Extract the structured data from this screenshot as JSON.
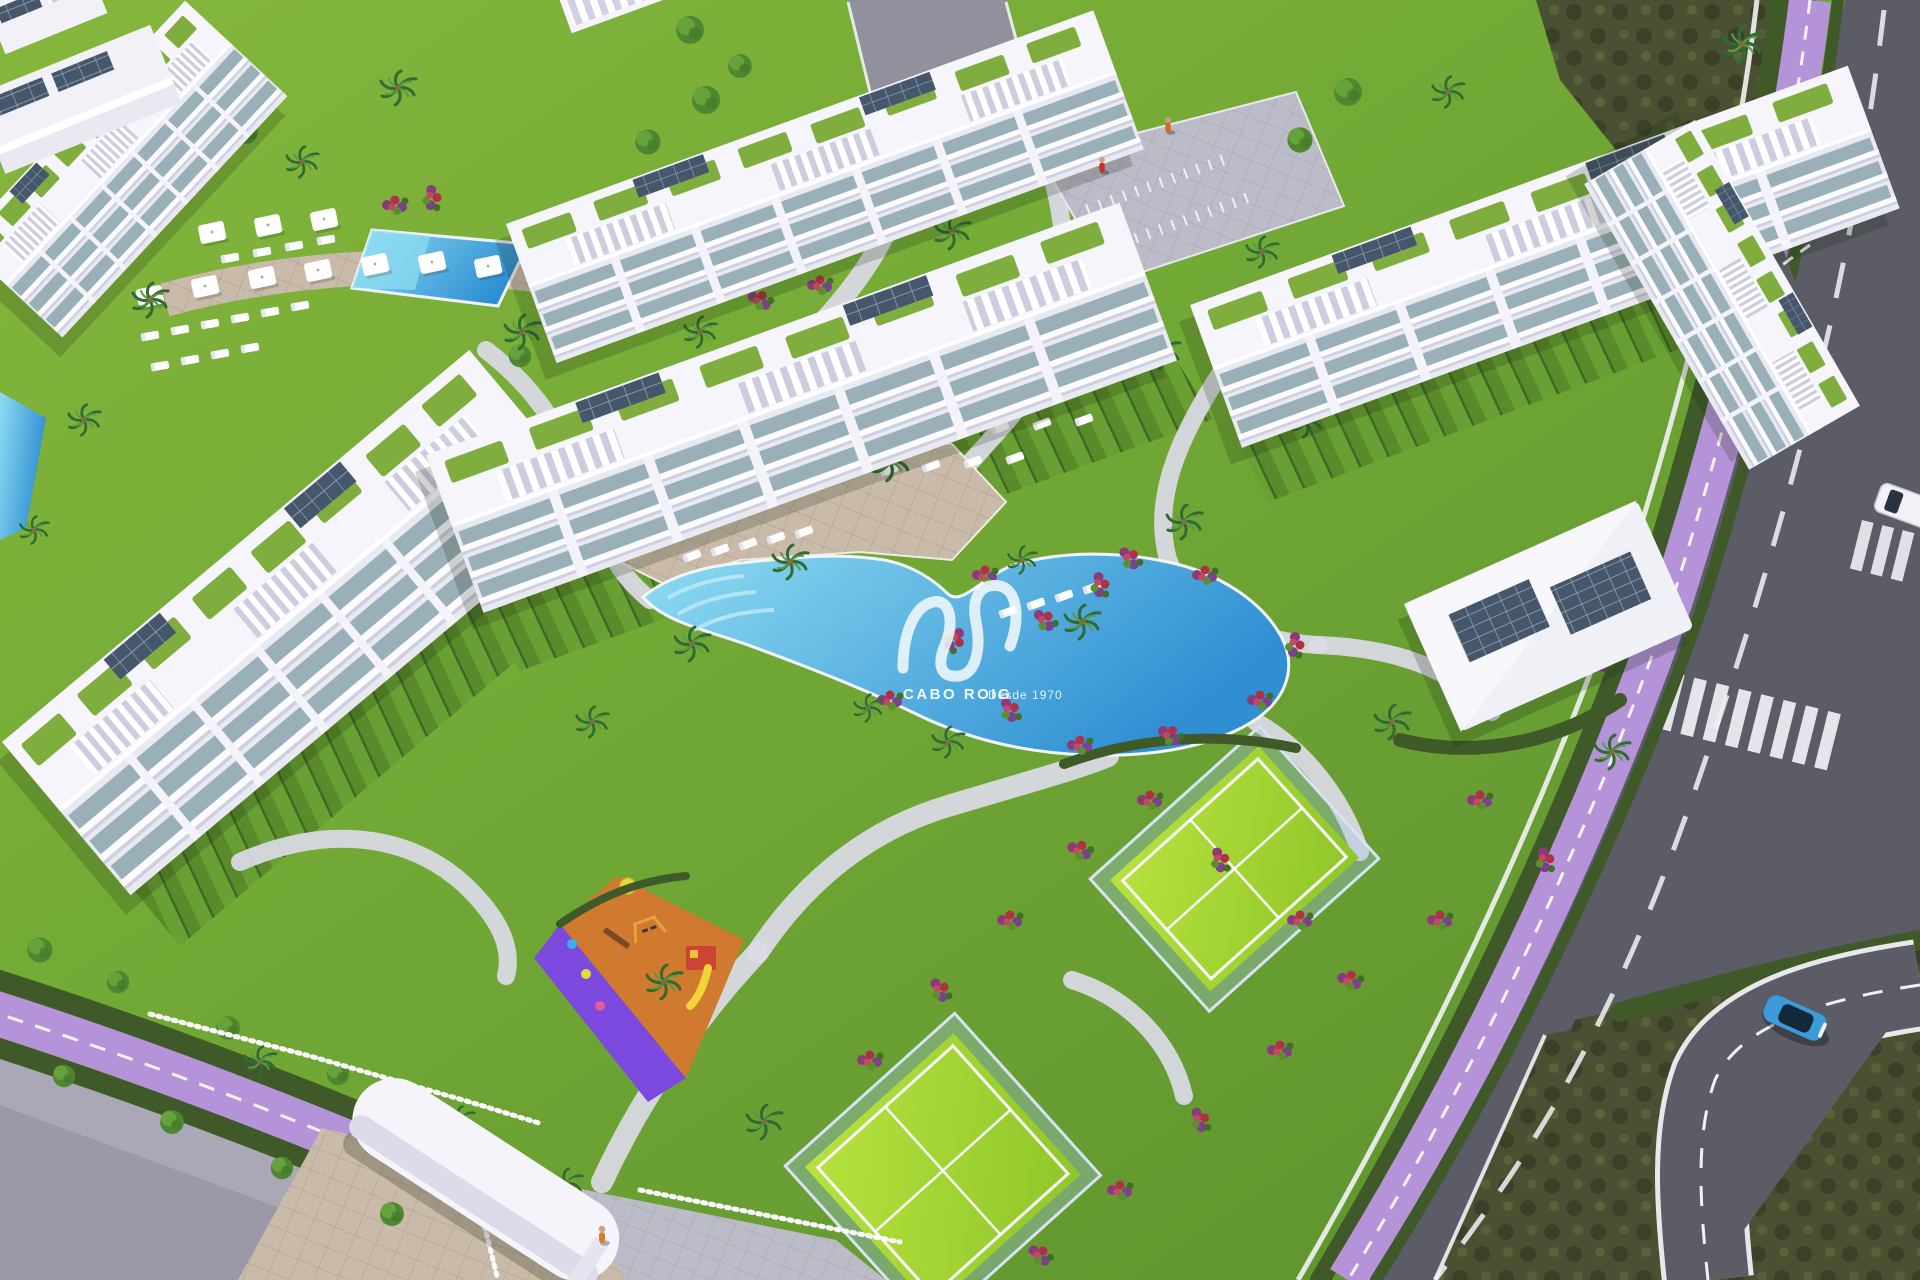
{
  "watermark": {
    "brand": "CABO ROIG",
    "tagline": "Desde 1970",
    "logo": "sis-swoosh-monogram"
  },
  "scene": {
    "type": "aerial-3d-render",
    "elements": [
      "white-apartment-buildings-with-roof-terraces",
      "central-lagoon-pool",
      "secondary-pool",
      "sun-deck-with-loungers-and-parasols",
      "padel-court-upper",
      "padel-court-lower",
      "children-playground",
      "entrance-gate-canopy",
      "perimeter-road",
      "purple-bike-lane",
      "curved-branch-road",
      "blue-car",
      "white-van",
      "scrubland",
      "palm-trees",
      "flower-beds",
      "pool-clubhouse",
      "bike-rack-plaza",
      "pedestrian-crosswalk",
      "white-picket-fence"
    ],
    "people_visible": 3,
    "vehicles_visible": 2
  },
  "palette": {
    "lawn_light": "#85b73c",
    "lawn": "#6fa634",
    "lawn_dark": "#5b8f2e",
    "scrub": "#4a5132",
    "scrub_dark": "#3a4128",
    "asphalt": "#5b5c66",
    "asphalt_light": "#90919c",
    "bike_path": "#b493d8",
    "sidewalk": "#aaa8b6",
    "paving": "#c9baa9",
    "building_white": "#f1f1f7",
    "glass": "#9ab0b8",
    "terrace": "#7fae3f",
    "pool_light": "#8fdcf2",
    "pool_blue": "#2f8fd2",
    "court_light": "#b7e23e",
    "court_green": "#8fc62a",
    "playground_orange": "#cf7a2e",
    "playground_purple": "#7b49dd",
    "hedge": "#3f5a28",
    "palm": "#2f6b33",
    "flower_red": "#b03048",
    "flower_purple": "#8e3a7a",
    "solar": "#46566b",
    "car_blue": "#3b9ad8",
    "marking_white": "#f2f2f5"
  }
}
